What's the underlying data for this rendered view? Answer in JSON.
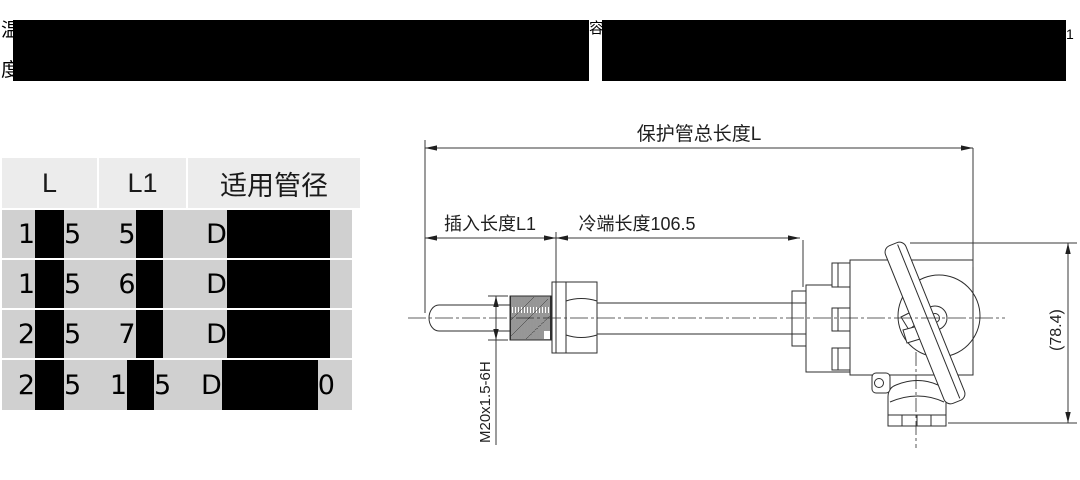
{
  "intro": {
    "visible_char_line1_start": "温",
    "visible_char_line1_mid": "容",
    "visible_char_line1_end": "1",
    "visible_char_line2_start": "度",
    "note": "paragraph text redacted by black bars"
  },
  "table": {
    "headers": [
      "L",
      "L1",
      "适用管径"
    ],
    "rows": [
      {
        "l_pre": "1",
        "l_post": "5",
        "l1_pre": "5",
        "l1_post": "",
        "pipe_pre": "D",
        "pipe_post": ""
      },
      {
        "l_pre": "1",
        "l_post": "5",
        "l1_pre": "6",
        "l1_post": "",
        "pipe_pre": "D",
        "pipe_post": ""
      },
      {
        "l_pre": "2",
        "l_post": "5",
        "l1_pre": "7",
        "l1_post": "",
        "pipe_pre": "D",
        "pipe_post": ""
      },
      {
        "l_pre": "2",
        "l_post": "5",
        "l1_pre": "1",
        "l1_post": "5",
        "pipe_pre": "D",
        "pipe_post": "0"
      }
    ]
  },
  "drawing": {
    "dim_total_label": "保护管总长度L",
    "dim_insert_label": "插入长度L1",
    "dim_cold_label": "冷端长度106.5",
    "thread_spec": "M20x1.5-6H",
    "head_height": "(78.4)"
  },
  "colors": {
    "table_header_bg": "#ececec",
    "table_body_bg": "#d0d0d0",
    "redaction": "#000000",
    "line": "#2e2e2e"
  }
}
